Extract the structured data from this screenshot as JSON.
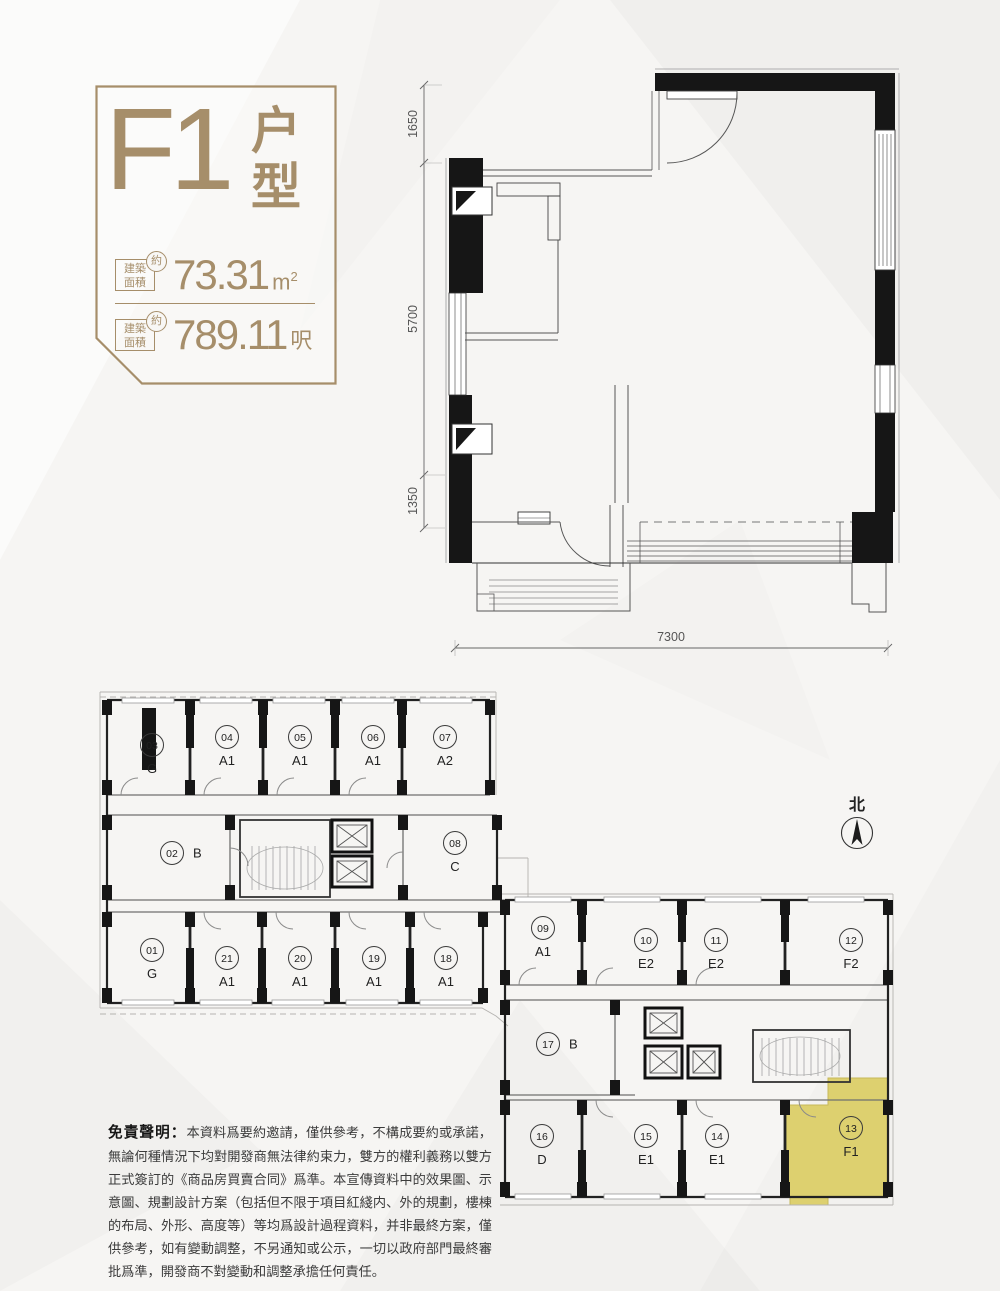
{
  "title_block": {
    "unit_name": "F1",
    "unit_type_chars": [
      "户",
      "型"
    ],
    "rows": [
      {
        "area_box_l1": "建築",
        "area_box_l2": "面積",
        "approx": "約",
        "value": "73.31",
        "unit": "m",
        "unit_sup": "2"
      },
      {
        "area_box_l1": "建築",
        "area_box_l2": "面積",
        "approx": "約",
        "value": "789.11",
        "unit": "呎",
        "unit_sup": ""
      }
    ]
  },
  "unit_plan": {
    "dims_left": [
      "1650",
      "5700",
      "1350"
    ],
    "dim_bottom": "7300"
  },
  "floor_plate": {
    "north_label": "北",
    "highlighted_unit": "13",
    "highlight_color": "#ddd06f",
    "units": [
      {
        "num": "03",
        "type": "G"
      },
      {
        "num": "04",
        "type": "A1"
      },
      {
        "num": "05",
        "type": "A1"
      },
      {
        "num": "06",
        "type": "A1"
      },
      {
        "num": "07",
        "type": "A2"
      },
      {
        "num": "02",
        "type": "B"
      },
      {
        "num": "08",
        "type": "C"
      },
      {
        "num": "01",
        "type": "G"
      },
      {
        "num": "21",
        "type": "A1"
      },
      {
        "num": "20",
        "type": "A1"
      },
      {
        "num": "19",
        "type": "A1"
      },
      {
        "num": "18",
        "type": "A1"
      },
      {
        "num": "09",
        "type": "A1"
      },
      {
        "num": "10",
        "type": "E2"
      },
      {
        "num": "11",
        "type": "E2"
      },
      {
        "num": "12",
        "type": "F2"
      },
      {
        "num": "17",
        "type": "B"
      },
      {
        "num": "16",
        "type": "D"
      },
      {
        "num": "15",
        "type": "E1"
      },
      {
        "num": "14",
        "type": "E1"
      },
      {
        "num": "13",
        "type": "F1"
      }
    ]
  },
  "disclaimer": {
    "heading": "免責聲明：",
    "body": "本資料爲要約邀請，僅供參考，不構成要約或承諾，無論何種情況下均對開發商無法律約束力，雙方的權利義務以雙方正式簽訂的《商品房買賣合同》爲準。本宣傳資料中的效果圖、示意圖、規劃設計方案（包括但不限于項目紅綫内、外的規劃，樓棟的布局、外形、高度等）等均爲設計過程資料，并非最終方案，僅供參考，如有變動調整，不另通知或公示，一切以政府部門最終審批爲準，開發商不對變動和調整承擔任何責任。"
  },
  "colors": {
    "gold": "#a68e6a",
    "wall": "#161616",
    "line": "#555555",
    "highlight": "#ddd06f"
  }
}
